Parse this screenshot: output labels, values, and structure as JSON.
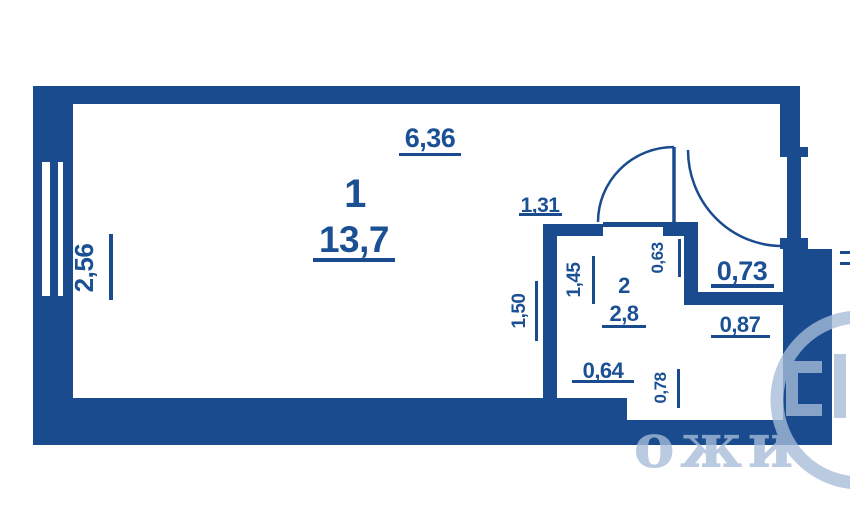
{
  "plan": {
    "type": "studio-apartment-floor-plan",
    "colors": {
      "wall": "#1a4b8e",
      "text": "#1c5094",
      "watermark": "#a6bcd9",
      "background": "#ffffff"
    },
    "rooms": [
      {
        "number": "1",
        "area": "13,7"
      },
      {
        "number": "2",
        "area": "2,8"
      }
    ],
    "dimensions": {
      "room1_width": "6,36",
      "room1_depth": "2,56",
      "doorway_width": "1,31",
      "room2_width": "1,45",
      "room2_depth": "1,50",
      "niche_top_width": "0,63",
      "balcony_niche_width": "0,73",
      "lower_niche_width": "0,87",
      "room2_lower_width": "0,64",
      "lower_niche_depth": "0,78"
    },
    "watermark": {
      "letters": "ожи"
    }
  }
}
